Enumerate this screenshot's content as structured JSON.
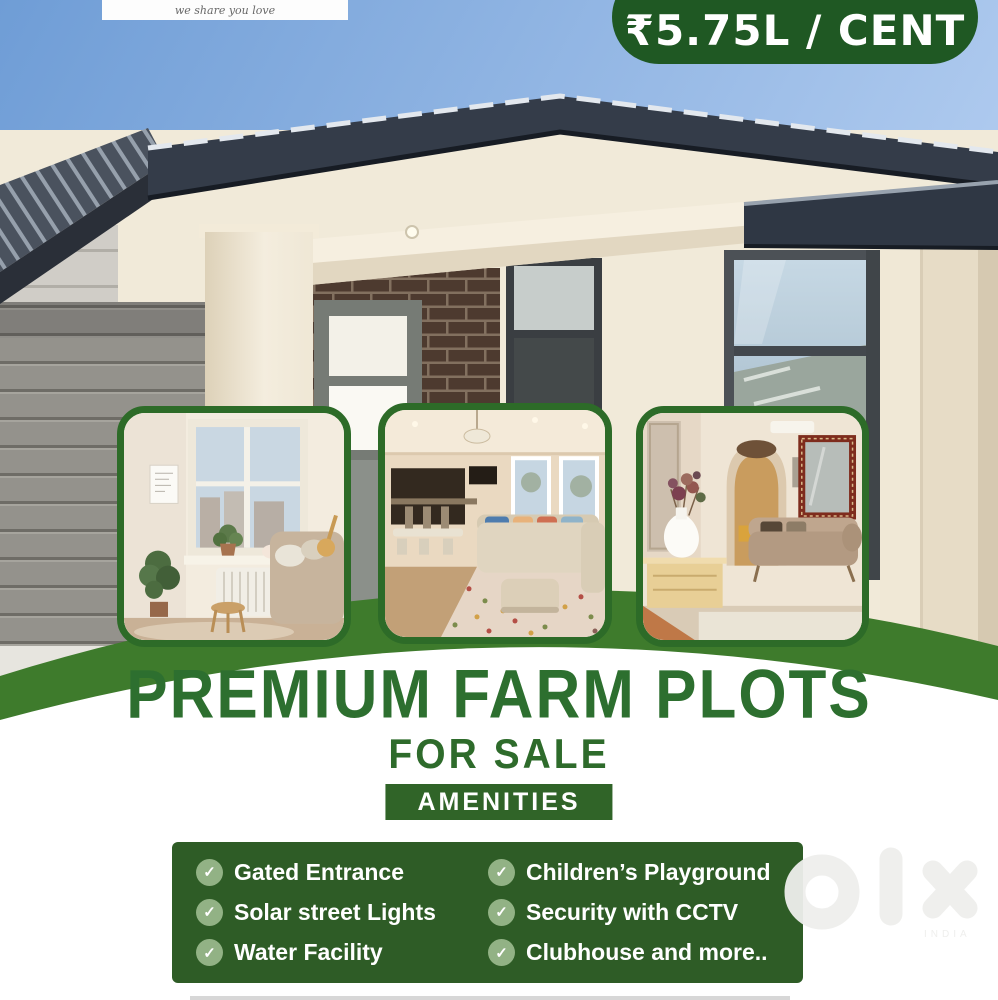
{
  "poster": {
    "brand_ribbon": {
      "tagline": "we share you love"
    },
    "price_badge": {
      "label": "₹5.75L / CENT"
    },
    "headline": {
      "title": "PREMIUM FARM PLOTS",
      "subtitle": "FOR SALE"
    },
    "amenities": {
      "label": "AMENITIES",
      "check_glyph": "✓",
      "columns": [
        {
          "items": [
            "Gated Entrance",
            "Solar street Lights",
            "Water Facility"
          ]
        },
        {
          "items": [
            "Children’s Playground",
            "Security with CCTV",
            "Clubhouse and more.."
          ]
        }
      ]
    },
    "gallery": [
      {
        "name": "cozy-living-room-photo"
      },
      {
        "name": "open-plan-living-room-photo"
      },
      {
        "name": "classic-living-room-photo"
      }
    ],
    "watermark": {
      "brand": "olx",
      "country": "INDIA"
    },
    "colors": {
      "deep_green": "#1f5823",
      "panel_green": "#2e5c26",
      "band_green": "#3e7b2c",
      "title_green": "#2d6f2f",
      "check_circle_green": "#92b285",
      "sky_blue": "#8fb3e2"
    }
  }
}
